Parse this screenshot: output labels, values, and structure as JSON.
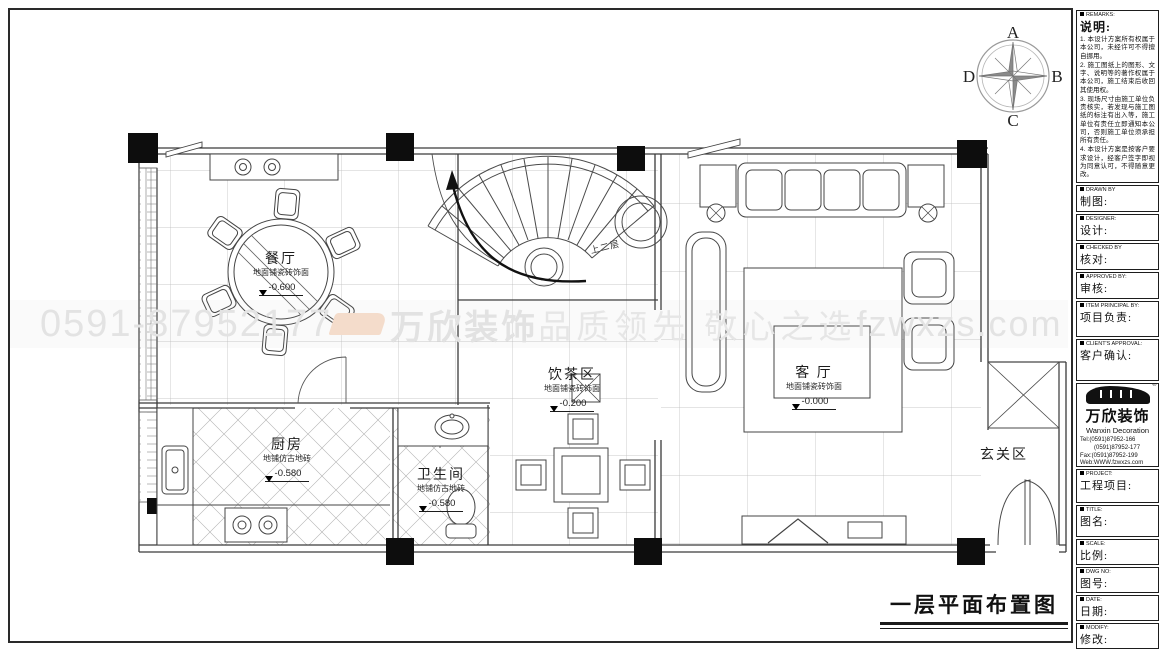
{
  "compass": {
    "n": "A",
    "e": "B",
    "s": "C",
    "w": "D"
  },
  "watermark": {
    "phone": "0591-87952177",
    "brand": "万欣装饰",
    "slogan": "品质领先 敬心之选",
    "site": "fzwxzs.com"
  },
  "drawing_title": "一层平面布置图",
  "rooms": {
    "dining": {
      "name": "餐厅",
      "finish": "地面铺瓷砖饰面",
      "level": "-0.600"
    },
    "tea": {
      "name": "饮茶区",
      "finish": "地面铺瓷砖饰面",
      "level": "-0.200"
    },
    "living": {
      "name": "客 厅",
      "finish": "地面铺瓷砖饰面",
      "level": "-0.000"
    },
    "kitchen": {
      "name": "厨房",
      "finish": "地铺仿古地砖",
      "level": "-0.580"
    },
    "bath": {
      "name": "卫生间",
      "finish": "地铺仿古地砖",
      "level": "-0.580"
    },
    "entry": {
      "name": "玄关区"
    },
    "stairs": {
      "note": "上二层"
    }
  },
  "titleblock": {
    "remarks": {
      "en": "REMARKS:",
      "zh": "说明:",
      "items": [
        "1. 本设计方案所有权属于本公司，未经许可不得擅自挪用。",
        "2. 施工图纸上的图形、文字、说明等的著作权属于本公司，施工结束后收回其使用权。",
        "3. 现场尺寸由施工单位负责核实，若发现与施工图纸的标注有出入等，施工单位有责任立即通知本公司，否则施工单位须承担所有责任。",
        "4. 本设计方案是按客户要求设计，经客户签字即视为同意认可，不得随意更改。"
      ]
    },
    "fields": [
      {
        "en": "DRAWN BY",
        "zh": "制图:"
      },
      {
        "en": "DESIGNER:",
        "zh": "设计:"
      },
      {
        "en": "CHECKED BY",
        "zh": "核对:"
      },
      {
        "en": "APPROVED BY:",
        "zh": "审核:"
      },
      {
        "en": "ITEM PRINCIPAL BY:",
        "zh": "项目负责:"
      },
      {
        "en": "CLIENT'S APPROVAL:",
        "zh": "客户确认:"
      }
    ],
    "company": {
      "reg": "®",
      "brand": "万欣装饰",
      "brand_en": "Wanxin Decoration",
      "tel1": "Tel:(0591)87952-166",
      "tel2": "(0591)87952-177",
      "fax": "Fax:(0591)87952-199",
      "web": "Web:WWW.fzwxzs.com"
    },
    "fields2": [
      {
        "en": "PROJECT:",
        "zh": "工程项目:"
      },
      {
        "en": "TITLE:",
        "zh": "图名:"
      },
      {
        "en": "SCALE:",
        "zh": "比例:"
      },
      {
        "en": "DWG NO:",
        "zh": "图号:"
      },
      {
        "en": "DATE:",
        "zh": "日期:"
      },
      {
        "en": "MODIFY:",
        "zh": "修改:"
      }
    ]
  }
}
